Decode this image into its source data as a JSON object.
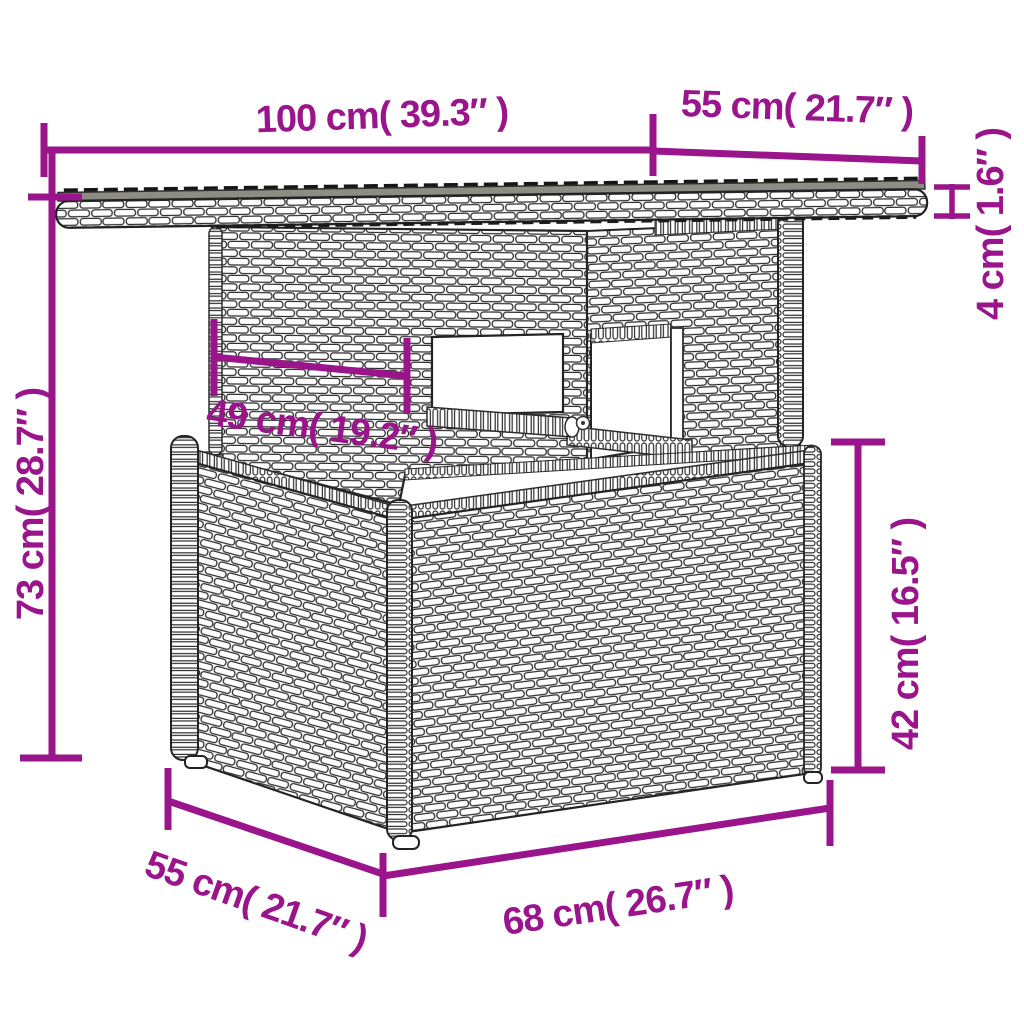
{
  "diagram": {
    "subject": "Poly rattan garden table with glass top - dimension drawing",
    "background": "#ffffff",
    "accent_color": "#9A148B",
    "line_art_color": "#262626",
    "glass_color": "#8D8D86",
    "dimensions": [
      {
        "id": "top-width",
        "cm": 100,
        "inches": 39.3,
        "label": "100 cm( 39.3″ )"
      },
      {
        "id": "top-depth",
        "cm": 55,
        "inches": 21.7,
        "label": "55 cm( 21.7″ )"
      },
      {
        "id": "top-thickness",
        "cm": 4,
        "inches": 1.6,
        "label": "4 cm( 1.6″ )"
      },
      {
        "id": "total-height",
        "cm": 73,
        "inches": 28.7,
        "label": "73 cm( 28.7″ )"
      },
      {
        "id": "pedestal-width",
        "cm": 49,
        "inches": 19.2,
        "label": "49 cm( 19.2″ )"
      },
      {
        "id": "base-height",
        "cm": 42,
        "inches": 16.5,
        "label": "42 cm( 16.5″ )"
      },
      {
        "id": "base-width",
        "cm": 68,
        "inches": 26.7,
        "label": "68 cm( 26.7″ )"
      },
      {
        "id": "base-depth",
        "cm": 55,
        "inches": 21.7,
        "label": "55 cm( 21.7″ )"
      }
    ]
  }
}
